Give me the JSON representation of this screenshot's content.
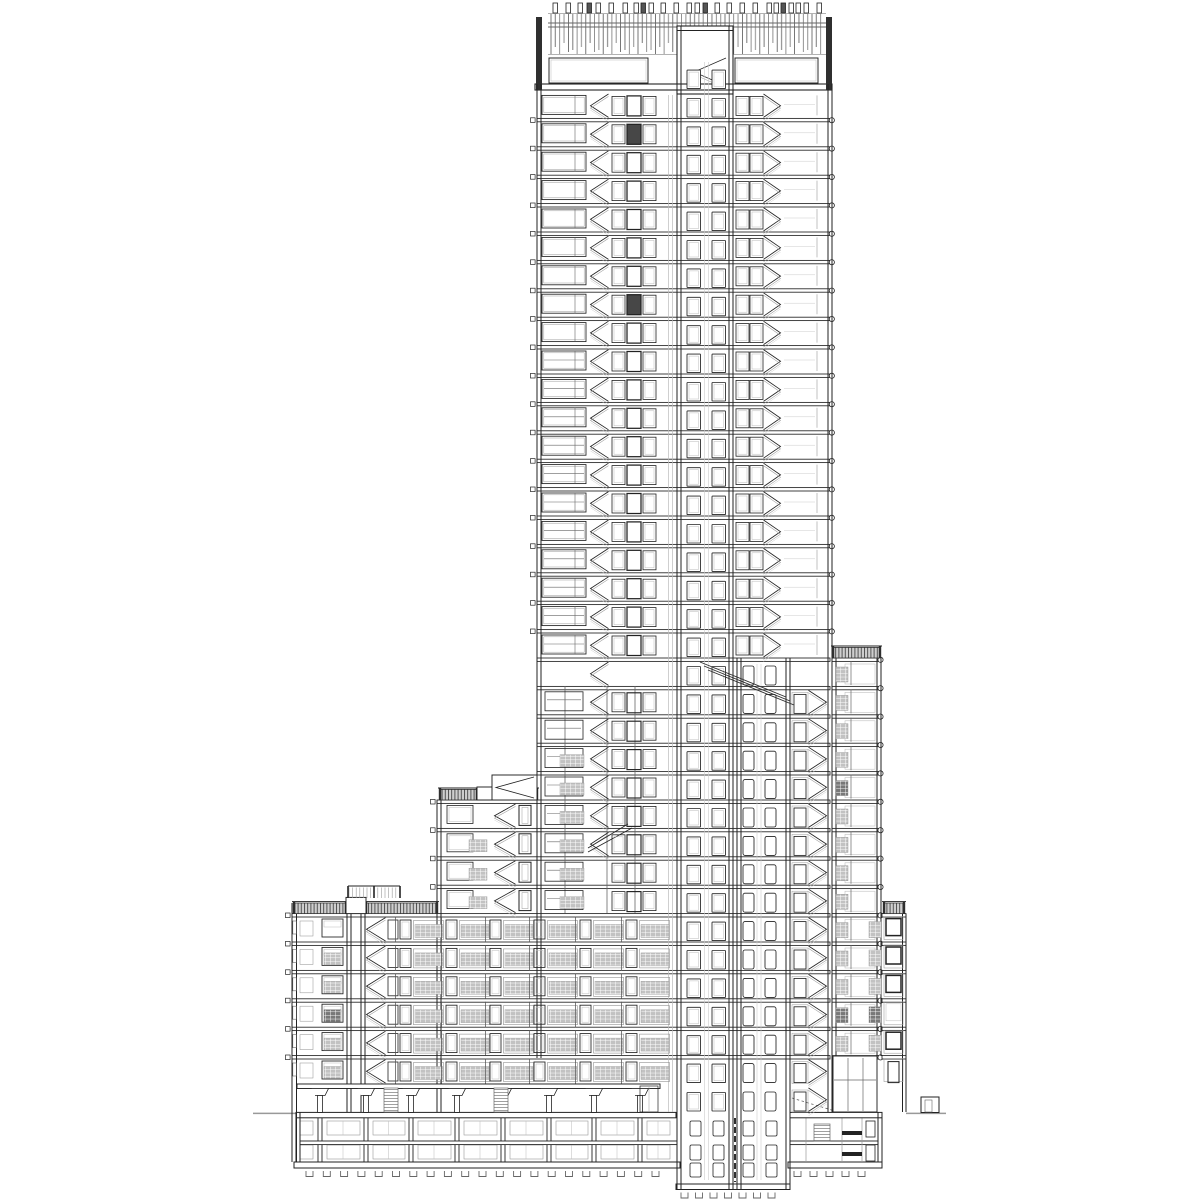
{
  "document": {
    "kind": "architectural-section-drawing",
    "description": "Black and white cross-section of a high-rise residential tower with central lift core, flanking stairs, stepped mid-rise wings, roof plant screen and two basement levels",
    "visible_text": []
  },
  "palette": {
    "bg": "#ffffff",
    "ink": "#222222",
    "dark": "#2f2f2f",
    "mid": "#666666",
    "light": "#999999",
    "faint": "#bbbbbb",
    "ghost": "#cccccc",
    "hatchLight": "#c2c2c2",
    "hatchDark": "#787878",
    "railFill": "#cfcfcf"
  },
  "drawing": {
    "grid": {
      "y0": 90,
      "pitch": 28.4,
      "ground": 1112.4
    },
    "slabRules": [
      {
        "i1": 1,
        "i2": 19,
        "x1": 537,
        "x2": 831,
        "sqL": 530.5,
        "circR": 831.8
      },
      {
        "i1": 20,
        "i2": 24,
        "x1": 537,
        "x2": 830
      },
      {
        "i1": 25,
        "i2": 28,
        "x1": 437,
        "x2": 830,
        "sqL": 430.5
      },
      {
        "i1": 29,
        "i2": 34,
        "x1": 292,
        "x2": 830,
        "sqL": 285.5
      },
      {
        "i1": 35,
        "i2": 35,
        "x1": 297,
        "x2": 660
      },
      {
        "i1": 20,
        "i2": 34,
        "x1": 832,
        "x2": 881,
        "circR": 880.5
      },
      {
        "i1": 29,
        "i2": 34,
        "x1": 882,
        "x2": 906
      }
    ],
    "wallPairs": [
      [
        537,
        541,
        84,
        1058
      ],
      [
        828,
        832,
        84,
        1112
      ],
      [
        437,
        441,
        800,
        1112
      ],
      [
        292,
        296.5,
        903,
        1162
      ],
      [
        832,
        836,
        658,
        1112
      ],
      [
        877,
        881,
        658,
        1056
      ],
      [
        902.5,
        906,
        913.6,
        1112
      ],
      [
        347,
        351,
        903,
        1112
      ],
      [
        361,
        365,
        903,
        1112
      ],
      [
        677,
        681,
        26,
        1189
      ],
      [
        729,
        733,
        26,
        1189
      ],
      [
        737,
        741,
        658,
        1189
      ],
      [
        786,
        790,
        658,
        1189
      ],
      [
        296,
        300,
        1112,
        1162
      ],
      [
        878,
        882,
        1112,
        1162
      ]
    ],
    "singleLines": [
      [
        668.5,
        95,
        1112,
        "faint",
        0.7
      ],
      [
        672.5,
        95,
        1112,
        "faint",
        0.7
      ],
      [
        704.5,
        62,
        1180,
        "ghost",
        0.6
      ],
      [
        708.5,
        62,
        1180,
        "ghost",
        0.6
      ],
      [
        757,
        664,
        1180,
        "ghost",
        0.6
      ],
      [
        761,
        664,
        1180,
        "ghost",
        0.6
      ],
      [
        565,
        686,
        913,
        "mid",
        0.8
      ],
      [
        607,
        686,
        913,
        "mid",
        0.8
      ],
      [
        635,
        686,
        913,
        "mid",
        0.8
      ]
    ],
    "crown": {
      "ticks": {
        "y": 3,
        "h": 10,
        "w": 4.5,
        "xs": [
          553,
          566,
          578,
          587,
          596,
          609,
          623,
          634,
          641,
          649,
          661,
          674,
          687,
          695,
          703,
          715,
          727,
          740,
          753,
          767,
          774,
          781,
          789,
          796,
          804,
          817
        ],
        "darkIdx": [
          3,
          8,
          14,
          21
        ]
      },
      "screen": {
        "x1": 551,
        "x2": 823,
        "yTop": 14,
        "step": 4.35,
        "bottoms": [
          54,
          47,
          54,
          43,
          52,
          50
        ],
        "rails": [
          23,
          27
        ],
        "frameY1": 13.5,
        "frameY2": 54.5
      },
      "posts": [
        [
          536,
          17,
          6,
          73
        ],
        [
          826,
          17,
          6,
          73
        ]
      ],
      "rooms": [
        [
          549,
          58,
          99,
          25
        ],
        [
          735,
          58,
          83,
          25
        ]
      ],
      "slab": [
        535,
        84,
        297,
        6
      ],
      "coreBox": [
        677,
        26,
        56,
        64
      ]
    },
    "core": {
      "xs": [
        687,
        712
      ],
      "w": 13.5,
      "h": 18.5,
      "from": -1,
      "to": 35
    },
    "shaft2": {
      "xs": [
        743,
        765
      ],
      "w": 11,
      "h": 19,
      "from": 20,
      "to": 35
    },
    "lobbyDoor": {
      "x": 794,
      "from": 21,
      "to": 35
    },
    "stairs": [
      {
        "x1": 590,
        "x2": 609,
        "from": 0,
        "to": 26,
        "dir": "l"
      },
      {
        "x1": 763,
        "x2": 781,
        "from": 0,
        "to": 19,
        "dir": "r"
      },
      {
        "x1": 808,
        "x2": 827,
        "from": 21,
        "to": 35,
        "dir": "r"
      },
      {
        "x1": 494,
        "x2": 516,
        "from": 25,
        "to": 28,
        "dir": "l"
      },
      {
        "x1": 366,
        "x2": 386,
        "from": 29,
        "to": 34,
        "dir": "l"
      }
    ],
    "setbackFlight": [
      [
        700,
        662,
        786,
        697
      ],
      [
        704,
        666,
        790,
        701
      ],
      [
        708,
        670,
        794,
        705
      ]
    ],
    "endFlight": [
      [
        588,
        848,
        628,
        824
      ],
      [
        588,
        852,
        632,
        828
      ]
    ],
    "upper": {
      "from": 0,
      "to": 19,
      "winX": 542,
      "winW": 44,
      "mullion": 575,
      "transomFrom": 9,
      "doors3": [
        612,
        627,
        643
      ],
      "doorDarkFloors": [
        1,
        7
      ],
      "doors2": [
        736,
        750
      ],
      "rightPart": 817
    },
    "lowerLeft": {
      "from": 21,
      "to": 28,
      "winX": 545,
      "winW": 38,
      "hatchFrom": 23,
      "hatchX": 560,
      "hatchW": 24
    },
    "midBlock": {
      "from": 25,
      "to": 28,
      "winX": 447,
      "winW": 26,
      "hatchX": 469,
      "hatchW": 18,
      "hatchFrom": 26,
      "doorX": 519
    },
    "lowBlock": {
      "from": 29,
      "to": 34,
      "wallWinX": 292.8,
      "smallWinX": 300,
      "winX": 322,
      "winW": 21,
      "hatchX": 324,
      "hatchW": 17,
      "doorX": 388,
      "darkFloors": [
        32
      ],
      "lightFloors": [
        30,
        31,
        33,
        34
      ]
    },
    "bays": {
      "xs": [
        400,
        446,
        490,
        534,
        580,
        626
      ],
      "from": 29,
      "to": 34,
      "doorW": 11,
      "frameW": 30,
      "hatchW": 28
    },
    "wing": {
      "from": 20,
      "to": 33,
      "hatchLX": 836,
      "hatchRX": 869,
      "hatchRFrom": 29,
      "mullion": 851,
      "frameX": 845,
      "frameW": 30,
      "darkFloors": [
        24,
        32
      ],
      "circX": 880.5,
      "storefront": {
        "x": 833,
        "y": 1056,
        "w": 44,
        "h": 56,
        "mullions": [
          848,
          863
        ],
        "transom": 1080
      }
    },
    "rightBay": {
      "x": 884,
      "from": 29,
      "to": 34,
      "heavy": [
        29,
        30,
        31,
        33
      ],
      "plain": [
        32
      ],
      "doorFloor": 34
    },
    "railings": [
      {
        "x": 294,
        "w": 52,
        "i": 29
      },
      {
        "x": 366,
        "w": 71,
        "i": 29
      },
      {
        "x": 440,
        "w": 37,
        "i": 25
      },
      {
        "x": 504,
        "w": 33,
        "i": 25
      },
      {
        "x": 833,
        "w": 47,
        "i": 20
      },
      {
        "x": 884,
        "w": 20,
        "i": 29
      }
    ],
    "roofBoxes": [
      [
        477,
        787,
        27,
        13
      ],
      [
        346,
        897.4,
        20,
        16.2
      ]
    ],
    "penthouseRail": {
      "x1": 349,
      "x2": 399,
      "y1": 886,
      "y2": 898,
      "step": 3.6,
      "midPost": 374
    },
    "bulkhead": {
      "x": 492,
      "y": 775,
      "w": 45,
      "h": 25
    },
    "groundFloor": {
      "beam": [
        297,
        1084,
        363,
        4.5
      ],
      "cols": [
        320,
        366,
        411,
        457,
        503,
        549,
        594,
        640
      ],
      "capW": 17,
      "capH": 7,
      "ladders": [
        [
          384,
          1088,
          14,
          24
        ],
        [
          494,
          1088,
          14,
          24
        ]
      ],
      "glassDoor": [
        640,
        1086,
        18,
        26
      ]
    },
    "groundLine": {
      "y": 1113.4,
      "segments": [
        [
          253,
          296
        ],
        [
          906,
          946
        ]
      ]
    },
    "entranceBox": [
      921,
      1097,
      18,
      15.5
    ],
    "rampDash": [
      792,
      1098,
      838,
      1112
    ],
    "basement": {
      "topSlabs": [
        [
          296,
          1112.4,
          380,
          5.4
        ],
        [
          790,
          1112.4,
          92,
          5.4
        ]
      ],
      "left": {
        "cols": [
          320,
          366,
          411,
          457,
          503,
          549,
          594,
          640
        ],
        "colY1": 1118,
        "colY2": 1162,
        "x1": 300,
        "x2": 676,
        "rows": [
          [
            1121,
            14
          ],
          [
            1145,
            14
          ]
        ],
        "slab2": [
          300,
          1141,
          377,
          3.6
        ],
        "bottom": [
          294,
          1162,
          386,
          6
        ],
        "pads": {
          "y": 1171,
          "from": 306,
          "to": 668,
          "step": 17.3
        }
      },
      "pit": {
        "x1": 678,
        "x2": 788,
        "midWall": 735,
        "bottom": [
          676,
          1184,
          114,
          5.5
        ],
        "rows": [
          [
            1121,
            15
          ],
          [
            1145,
            15
          ],
          [
            1163,
            14
          ]
        ],
        "xs": [
          690,
          713,
          743,
          766
        ],
        "rw": 11,
        "pads": {
          "y": 1192.5,
          "from": 681,
          "to": 779,
          "step": 14.5
        }
      },
      "right": {
        "slab2": [
          790,
          1141,
          88,
          3.6
        ],
        "bottom": [
          788,
          1162,
          94,
          6
        ],
        "vlines": [
          806,
          842,
          862
        ],
        "ladder": [
          814,
          1124,
          16,
          17
        ],
        "beams": [
          [
            842,
            1131,
            20,
            4
          ],
          [
            842,
            1152,
            20,
            4
          ]
        ],
        "doors": [
          [
            866,
            1121,
            9,
            16
          ],
          [
            866,
            1145,
            9,
            16
          ]
        ],
        "pads": {
          "y": 1171,
          "from": 794,
          "to": 872,
          "step": 16
        }
      }
    }
  }
}
